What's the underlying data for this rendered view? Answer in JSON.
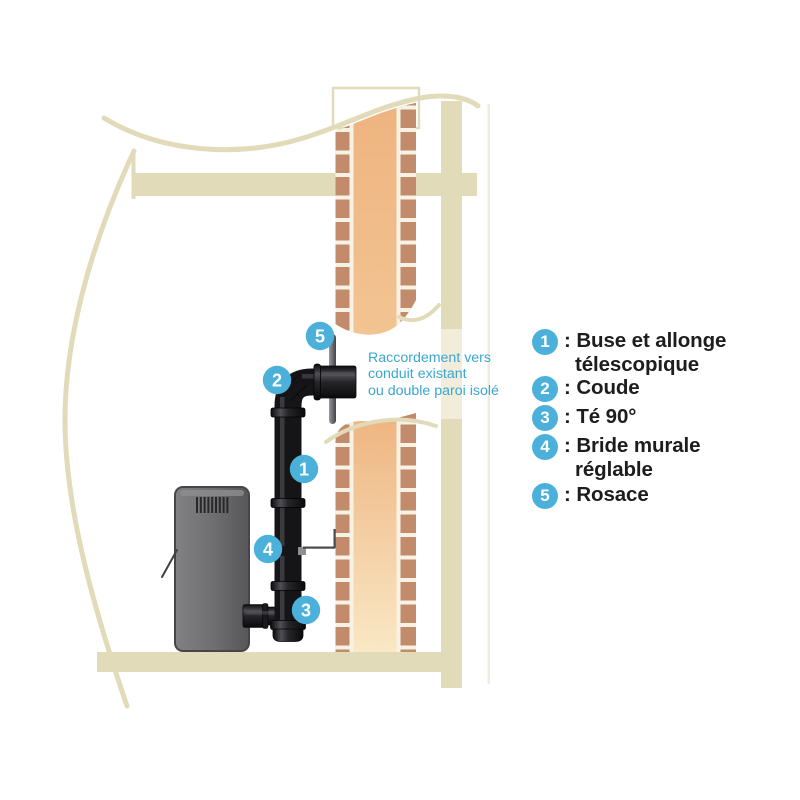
{
  "colors": {
    "badge_blue": "#4bb1db",
    "annotation_blue": "#3aa7d3",
    "wall_beige": "#e2dbba",
    "brick": "#c28b6c",
    "flue_orange": "#edb17d",
    "mortar_cream": "#f7f3e4",
    "pipe_black": "#151517",
    "stove_gray": "#6e6e71",
    "legend_text": "#1d1d1d"
  },
  "diagram": {
    "annotation": {
      "line1": "Raccordement vers",
      "line2": "conduit existant",
      "line3": "ou double paroi isolé"
    }
  },
  "legend": {
    "items": [
      {
        "number": "1",
        "line1": ": Buse et allonge",
        "line2": "télescopique"
      },
      {
        "number": "2",
        "line1": ": Coude",
        "line2": ""
      },
      {
        "number": "3",
        "line1": ": Té 90°",
        "line2": ""
      },
      {
        "number": "4",
        "line1": ": Bride murale",
        "line2": "réglable"
      },
      {
        "number": "5",
        "line1": ": Rosace",
        "line2": ""
      }
    ]
  }
}
